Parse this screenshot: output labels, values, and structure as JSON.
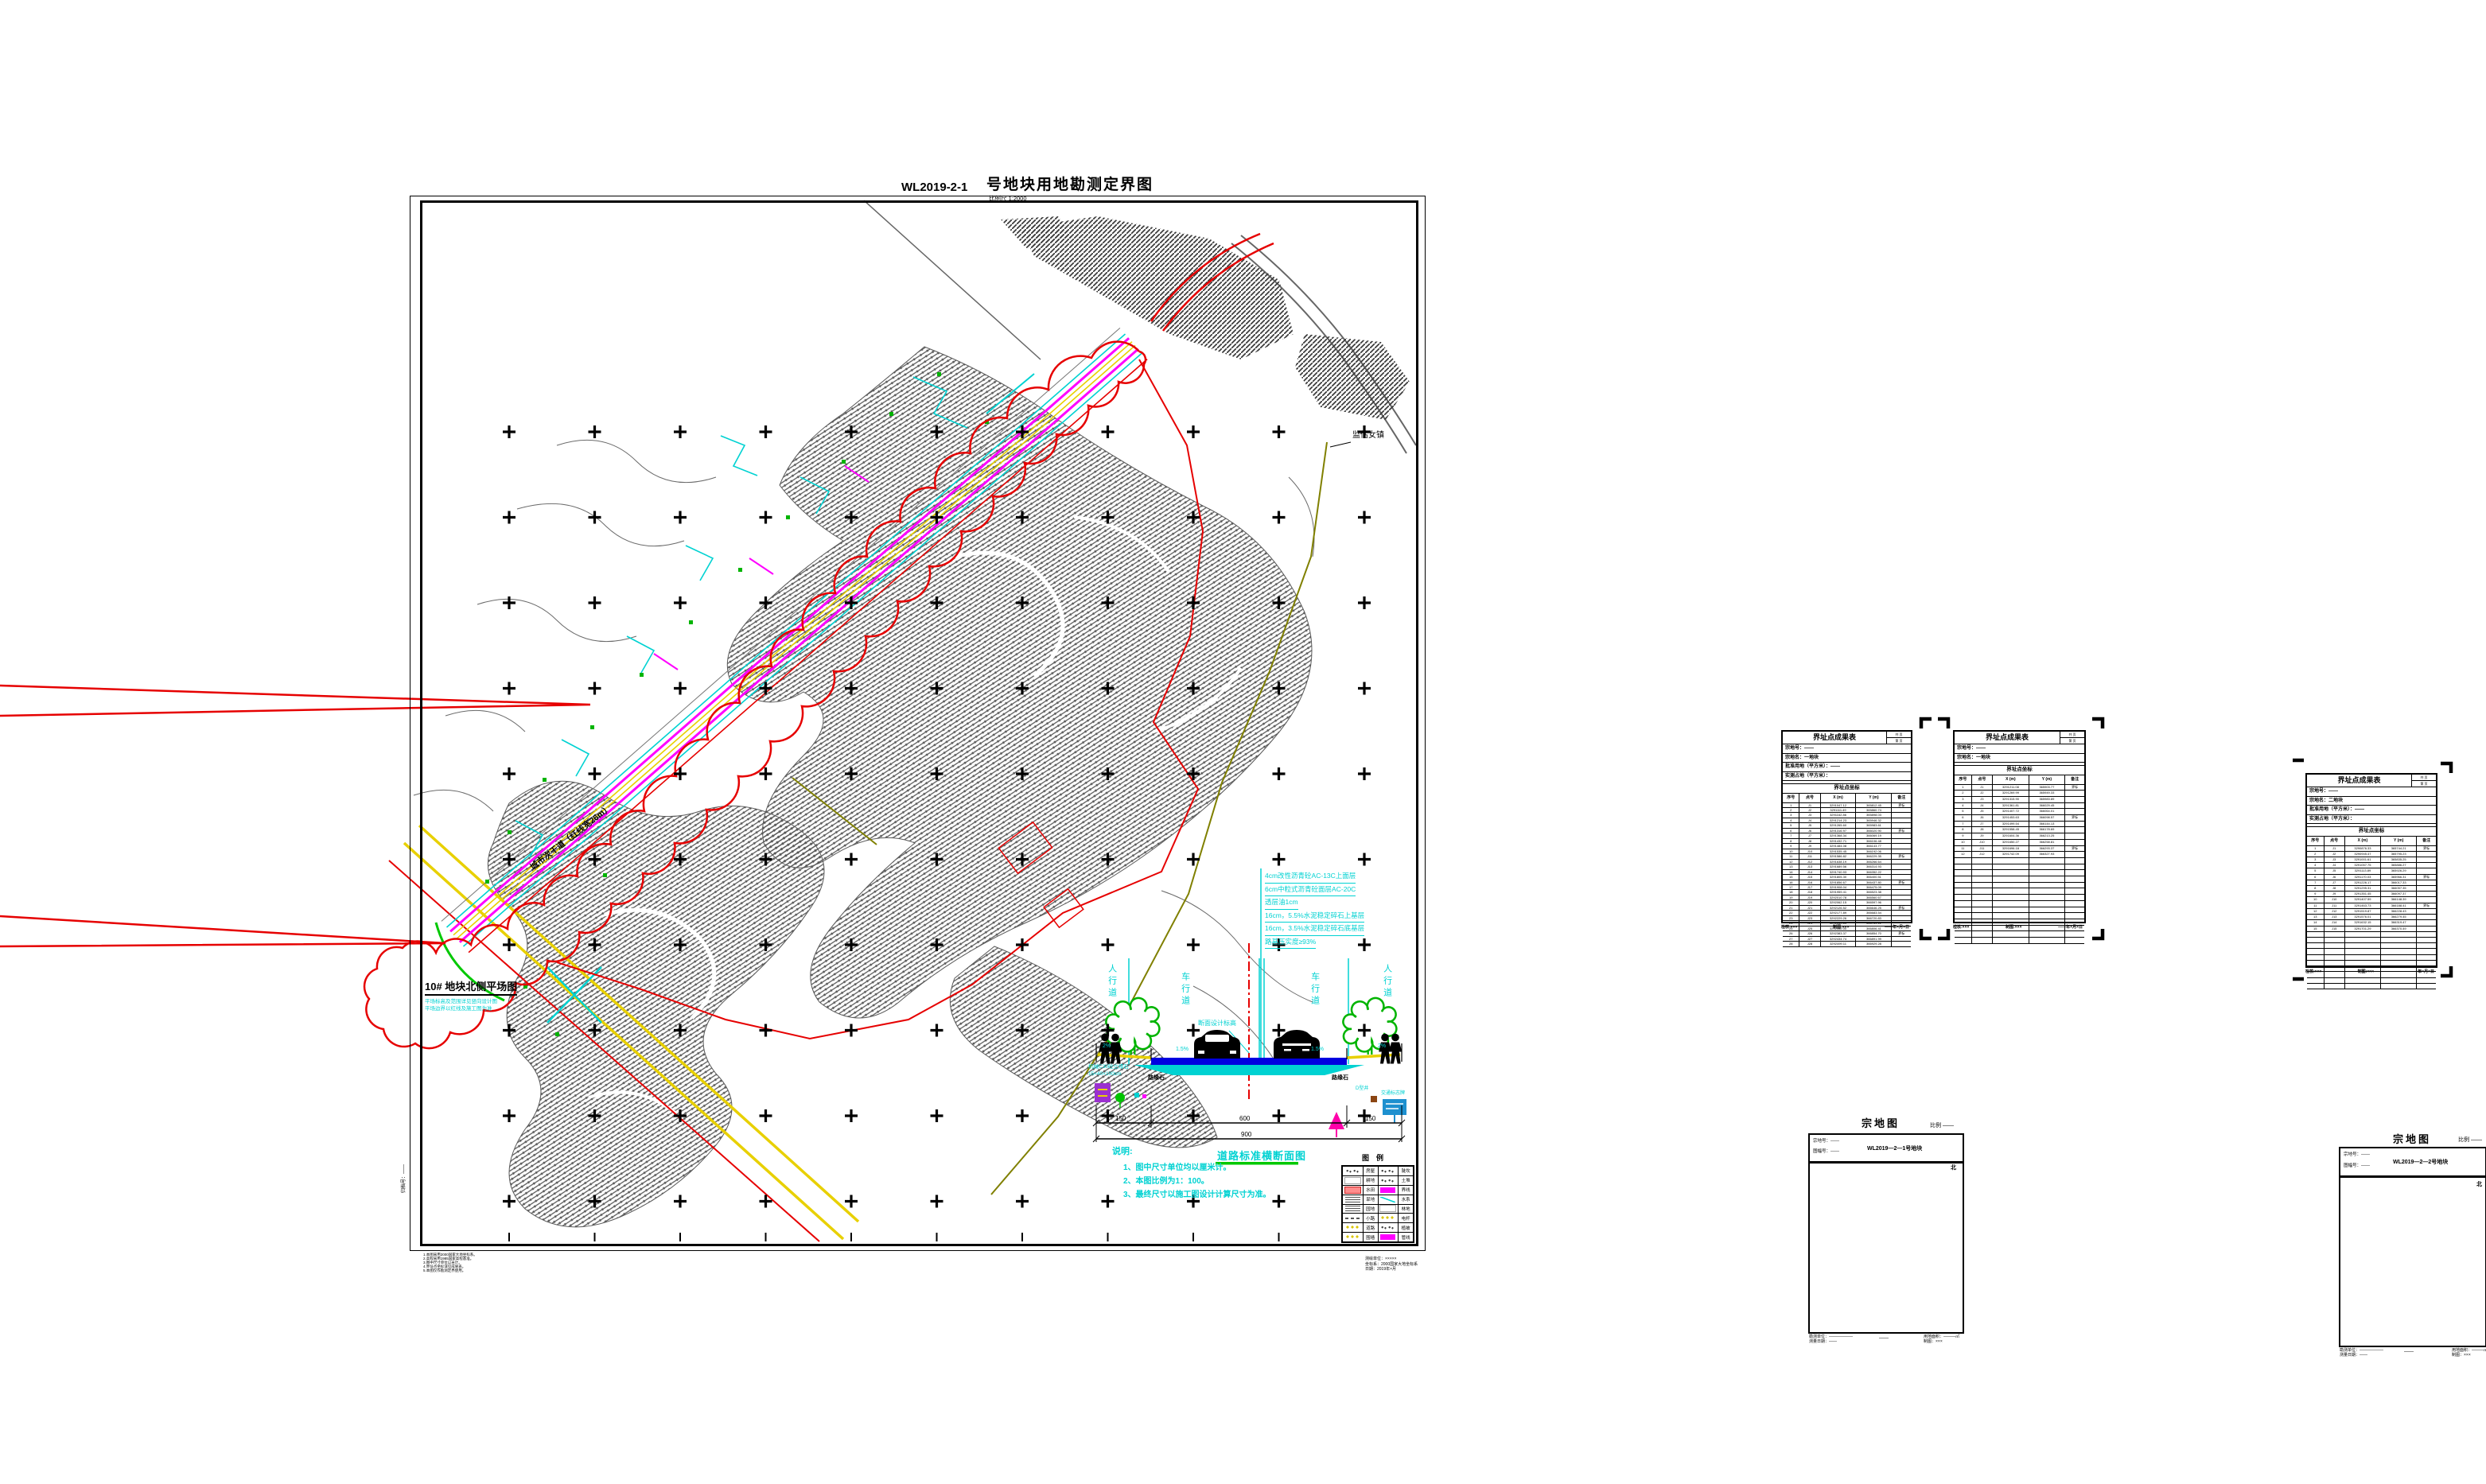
{
  "sheet": {
    "doc_no": "WL2019-2-1",
    "title": "号地块用地勘测定界图",
    "subtitle": "比例尺 1:2000",
    "archive_note": "归档号：——"
  },
  "map": {
    "plat_label": "10# 地块北侧平场图",
    "plat_sublines": [
      "平场标高及范围详见竖向设计图",
      "平场边界以红线及施工图为准"
    ],
    "road_label": "城市次干道（红线宽26m）",
    "town_label": "监估女镇",
    "bottom_left_notes": [
      "1.本图采用2000国家大地坐标系。",
      "2.高程采用1985国家高程基准。",
      "3.图中尺寸单位以米计。",
      "4.界址点坐标详见成果表。",
      "5.本图仅作勘测定界使用。"
    ],
    "bottom_right_notes": [
      "测绘单位：×××××",
      "坐标系：2000国家大地坐标系",
      "日期：2019年×月"
    ]
  },
  "section": {
    "zones": [
      "人行道",
      "车行道",
      "车行道",
      "人行道"
    ],
    "slopes": [
      "2%",
      "1.5%",
      "1.5%",
      "2%"
    ],
    "centerline_label": "断面设计标高",
    "curb_labels": [
      "路缘石",
      "路缘石"
    ],
    "curb_note_lines": [
      "机械C30砼立缘石",
      "15×40×100cm"
    ],
    "layers": [
      "4cm改性沥青砼AC-13C上面层",
      "6cm中粒式沥青砼面层AC-20C",
      "透层油1cm",
      "16cm，5.5%水泥稳定碎石上基层",
      "16cm，3.5%水泥稳定碎石底基层",
      "路基压实度≥93%"
    ],
    "dims": [
      "150",
      "600",
      "150"
    ],
    "dim_total": "900",
    "right_items": [
      "D型井",
      "交通标志牌"
    ],
    "title": "道路标准横断面图",
    "notes_title": "说明:",
    "notes": [
      "1、图中尺寸单位均以厘米计。",
      "2、本图比例为1：100。",
      "3、最终尺寸以施工图设计计算尺寸为准。"
    ]
  },
  "legend": {
    "title": "图　例",
    "items": [
      {
        "swatch": "dots",
        "label": "房屋"
      },
      {
        "swatch": "dots",
        "label": "陡坎"
      },
      {
        "swatch": "white",
        "label": "耕地"
      },
      {
        "swatch": "dots",
        "label": "土堆"
      },
      {
        "swatch": "pink",
        "label": "水田"
      },
      {
        "swatch": "mag",
        "label": "界线"
      },
      {
        "swatch": "lines",
        "label": "旱地"
      },
      {
        "swatch": "cyan",
        "label": "水系"
      },
      {
        "swatch": "lines",
        "label": "园地"
      },
      {
        "swatch": "white",
        "label": "林地"
      },
      {
        "swatch": "dash",
        "label": "小路"
      },
      {
        "swatch": "ydots",
        "label": "电杆"
      },
      {
        "swatch": "ydots",
        "label": "道路"
      },
      {
        "swatch": "dots",
        "label": "植被"
      },
      {
        "swatch": "ydots",
        "label": "围墙"
      },
      {
        "swatch": "mag",
        "label": "管线"
      }
    ]
  },
  "tables": [
    {
      "title": "界址点成果表",
      "page_box": [
        "共 页",
        "第 页"
      ],
      "info_rows": [
        "宗地号：——",
        "宗地名：一地块",
        "批准用地（平方米）：——",
        "实测占地（平方米）："
      ],
      "section_header": "界址点坐标",
      "columns": [
        "序号",
        "点号",
        "X (m)",
        "Y (m)",
        "备注"
      ],
      "filled_rows": 28,
      "empty_rows": 0,
      "x_base": 3291047.12,
      "x_step": 53.37,
      "y_base": 365812.45,
      "y_step": 41.29,
      "footer": [
        "检核:×××",
        "制图:×××",
        "——年×月×日"
      ]
    },
    {
      "title": "界址点成果表",
      "page_box": [
        "共 页",
        "第 页"
      ],
      "info_rows": [
        "宗地号：——",
        "宗地名：一地块"
      ],
      "section_header": "界址点坐标",
      "columns": [
        "序号",
        "点号",
        "X (m)",
        "Y (m)",
        "备注"
      ],
      "filled_rows": 12,
      "empty_rows": 14,
      "x_base": 3291211.08,
      "x_step": 47.91,
      "y_base": 365903.77,
      "y_step": 38.56,
      "footer": [
        "检核:×××",
        "制图:×××",
        "——年×月×日"
      ]
    },
    {
      "title": "界址点成果表",
      "page_box": [
        "共 页",
        "第 页"
      ],
      "info_rows": [
        "宗地号：——",
        "宗地名：二地块",
        "批准用地（平方米）：——",
        "实测占地（平方米）："
      ],
      "section_header": "界址点坐标",
      "columns": [
        "序号",
        "点号",
        "X (m)",
        "Y (m)",
        "备注"
      ],
      "filled_rows": 15,
      "empty_rows": 10,
      "x_base": 3290876.33,
      "x_step": 58.14,
      "y_base": 365744.21,
      "y_step": 44.02,
      "footer": [
        "检核:×××",
        "制图:×××",
        "——年×月×日"
      ]
    }
  ],
  "parcel_maps": [
    {
      "title": "宗地图",
      "scale_label": "比例 ——",
      "header_left": [
        "宗地号：——",
        "图幅号：——"
      ],
      "header_center": "WL2019—2—1号地块",
      "north_label": "北",
      "footer_left": [
        "勘测单位：——————",
        "测量日期：——"
      ],
      "footer_center": "——",
      "footer_right": [
        "用地面积：———㎡",
        "制图：×××"
      ]
    },
    {
      "title": "宗地图",
      "scale_label": "比例 ——",
      "header_left": [
        "宗地号：——",
        "图幅号：——"
      ],
      "header_center": "WL2019—2—2号地块",
      "north_label": "北",
      "footer_left": [
        "勘测单位：——————",
        "测量日期：——"
      ],
      "footer_center": "——",
      "footer_right": [
        "用地面积：———㎡",
        "制图：×××"
      ]
    }
  ]
}
